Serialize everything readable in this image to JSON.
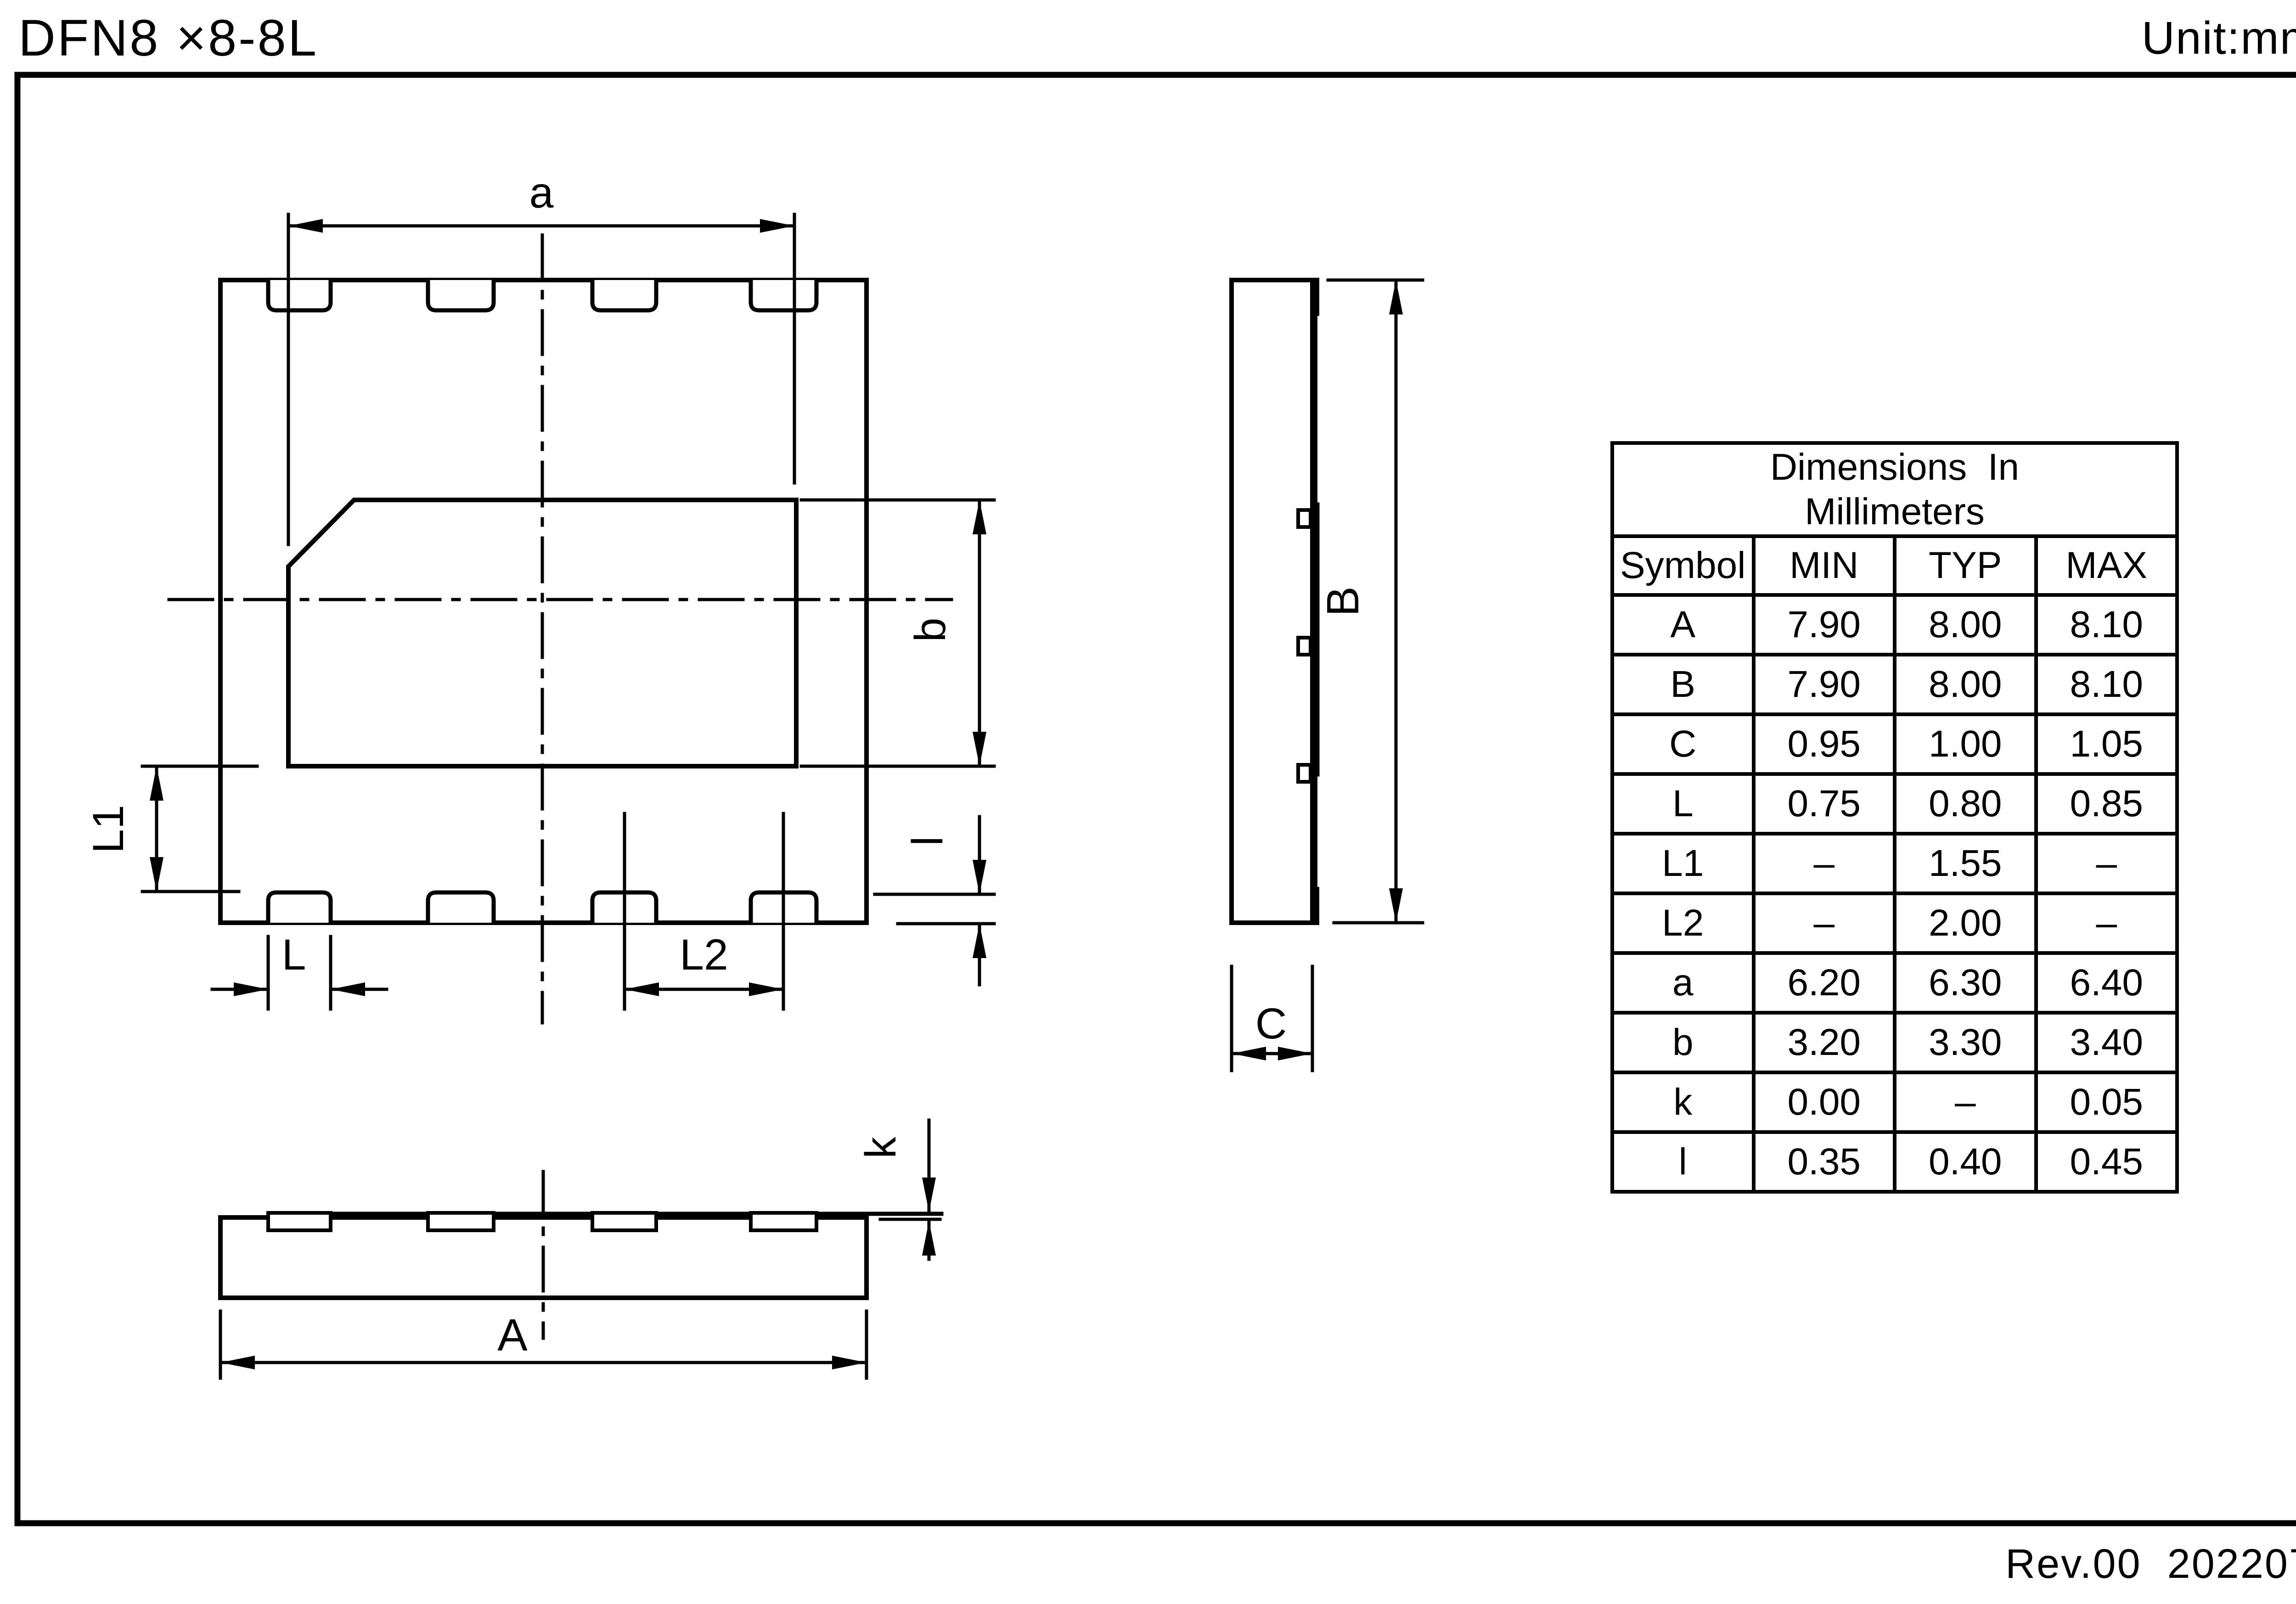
{
  "title": "DFN8 ×8-8L",
  "unit_label": "Unit:mm",
  "revision": "Rev.00  202207",
  "dims": {
    "a": "a",
    "b": "b",
    "small_l": "l",
    "L": "L",
    "L1": "L1",
    "L2": "L2",
    "A": "A",
    "B": "B",
    "C": "C",
    "k": "k"
  },
  "table": {
    "title_line1": "Dimensions  In",
    "title_line2": "Millimeters",
    "headers": [
      "Symbol",
      "MIN",
      "TYP",
      "MAX"
    ],
    "rows": [
      {
        "symbol": "A",
        "min": "7.90",
        "typ": "8.00",
        "max": "8.10"
      },
      {
        "symbol": "B",
        "min": "7.90",
        "typ": "8.00",
        "max": "8.10"
      },
      {
        "symbol": "C",
        "min": "0.95",
        "typ": "1.00",
        "max": "1.05"
      },
      {
        "symbol": "L",
        "min": "0.75",
        "typ": "0.80",
        "max": "0.85"
      },
      {
        "symbol": "L1",
        "min": "–",
        "typ": "1.55",
        "max": "–"
      },
      {
        "symbol": "L2",
        "min": "–",
        "typ": "2.00",
        "max": "–"
      },
      {
        "symbol": "a",
        "min": "6.20",
        "typ": "6.30",
        "max": "6.40"
      },
      {
        "symbol": "b",
        "min": "3.20",
        "typ": "3.30",
        "max": "3.40"
      },
      {
        "symbol": "k",
        "min": "0.00",
        "typ": "–",
        "max": "0.05"
      },
      {
        "symbol": "l",
        "min": "0.35",
        "typ": "0.40",
        "max": "0.45"
      }
    ]
  }
}
